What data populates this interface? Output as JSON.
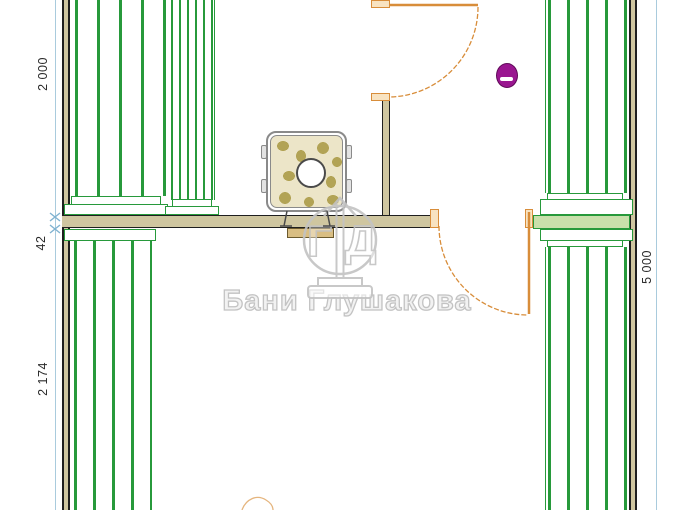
{
  "watermark": {
    "brand": "Бани Глушакова",
    "logo_letter_g": "Г",
    "logo_letter_d": "Д"
  },
  "dimensions": {
    "left_top": "2 000",
    "left_middle": "42",
    "left_bottom": "2 174",
    "right": "5 000"
  },
  "icons": {
    "stove": "sauna-stove-plan-symbol",
    "light": "light-fixture-symbol",
    "door": "door-swing-arc-symbol"
  },
  "colors": {
    "background": "#ffffff",
    "wall_green": "#27993b",
    "wall_green_fill": "#c9e0ab",
    "wall_tan": "#cfc6a0",
    "wall_line": "#1f1f1f",
    "door_orange": "#d88d3a",
    "door_jamb_fill": "#f8e3c1",
    "dim_blue": "#a9cbdd",
    "dim_tick_blue": "#7fb2d0",
    "dim_text": "#2b2b2b",
    "lamp_purple": "#9a1690",
    "stove_gray": "#8a8a8a",
    "stove_stone": "#b2a355",
    "stove_base": "#ece5c8",
    "firebox_tan": "#d9be83",
    "watermark_gray": "#c3c3c3"
  }
}
